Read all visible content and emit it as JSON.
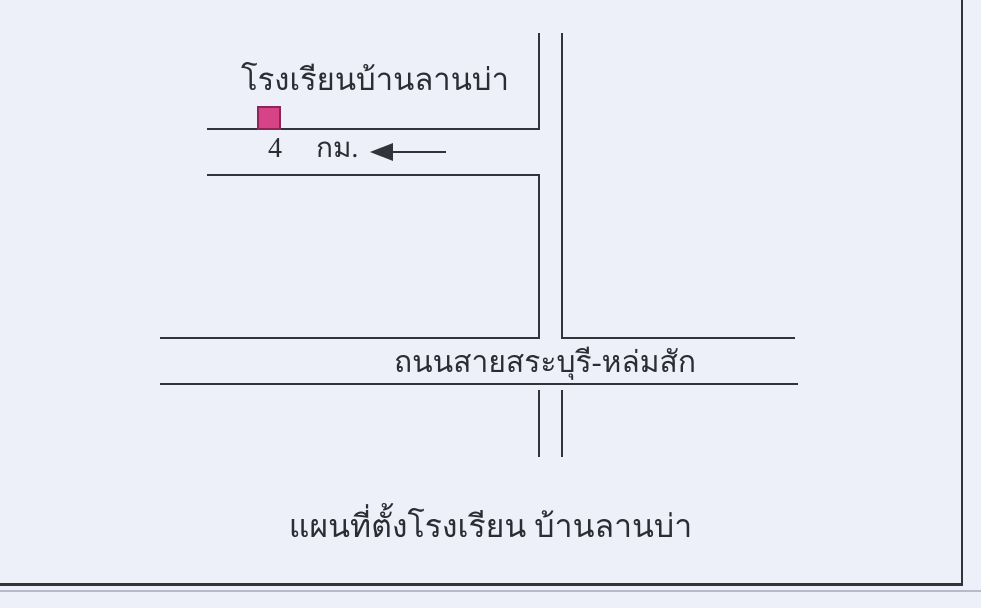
{
  "page": {
    "background": "#eef0f9",
    "line_color": "#32333b",
    "text_color": "#2b2c34"
  },
  "map": {
    "school_label": "โรงเรียนบ้านลานบ่า",
    "distance": {
      "value": "4",
      "unit": "กม."
    },
    "marker": {
      "meaning": "school-location",
      "fill": "#d64387",
      "border": "#8e2558"
    },
    "road_label": "ถนนสายสระบุรี-หล่มสัก",
    "caption": "แผนที่ตั้งโรงเรียน บ้านลานบ่า"
  }
}
